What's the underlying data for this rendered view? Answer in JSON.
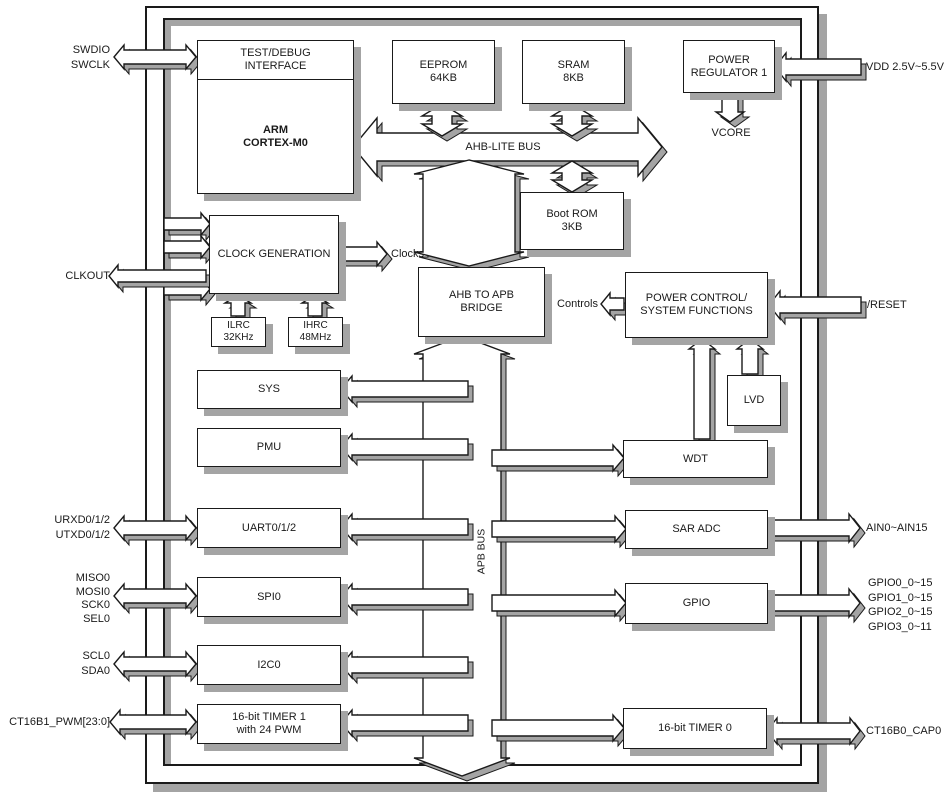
{
  "blocks": {
    "test_debug": "TEST/DEBUG\nINTERFACE",
    "arm_core": "ARM\nCORTEX-M0",
    "eeprom": "EEPROM\n64KB",
    "sram": "SRAM\n8KB",
    "power_regulator": "POWER\nREGULATOR 1",
    "boot_rom": "Boot ROM\n3KB",
    "clock_generation": "CLOCK GENERATION",
    "ilrc": "ILRC\n32KHz",
    "ihrc": "IHRC\n48MHz",
    "ahb_apb_bridge": "AHB TO APB\nBRIDGE",
    "power_control": "POWER CONTROL/\nSYSTEM FUNCTIONS",
    "lvd": "LVD",
    "sys": "SYS",
    "pmu": "PMU",
    "uart": "UART0/1/2",
    "spi": "SPI0",
    "i2c": "I2C0",
    "timer1": "16-bit TIMER 1\nwith 24 PWM",
    "wdt": "WDT",
    "sar_adc": "SAR ADC",
    "gpio": "GPIO",
    "timer0": "16-bit TIMER 0"
  },
  "buses": {
    "ahb_lite": "AHB-LITE BUS",
    "apb": "APB BUS"
  },
  "signals": {
    "clocks": "Clocks",
    "controls": "Controls",
    "vcore": "VCORE"
  },
  "pins_left": {
    "swd": "SWDIO\nSWCLK",
    "clkout": "CLKOUT",
    "uart": "URXD0/1/2\nUTXD0/1/2",
    "spi": "MISO0\nMOSI0\nSCK0\nSEL0",
    "i2c": "SCL0\nSDA0",
    "timer1": "CT16B1_PWM[23:0]"
  },
  "pins_right": {
    "vdd": "VDD 2.5V~5.5V",
    "reset": "/RESET",
    "adc": "AIN0~AIN15",
    "gpio": "GPIO0_0~15\nGPIO1_0~15\nGPIO2_0~15\nGPIO3_0~11",
    "timer0": "CT16B0_CAP0"
  },
  "colors": {
    "line": "#1a1a1a",
    "shadow": "#a4a4a4",
    "fill": "#ffffff"
  }
}
